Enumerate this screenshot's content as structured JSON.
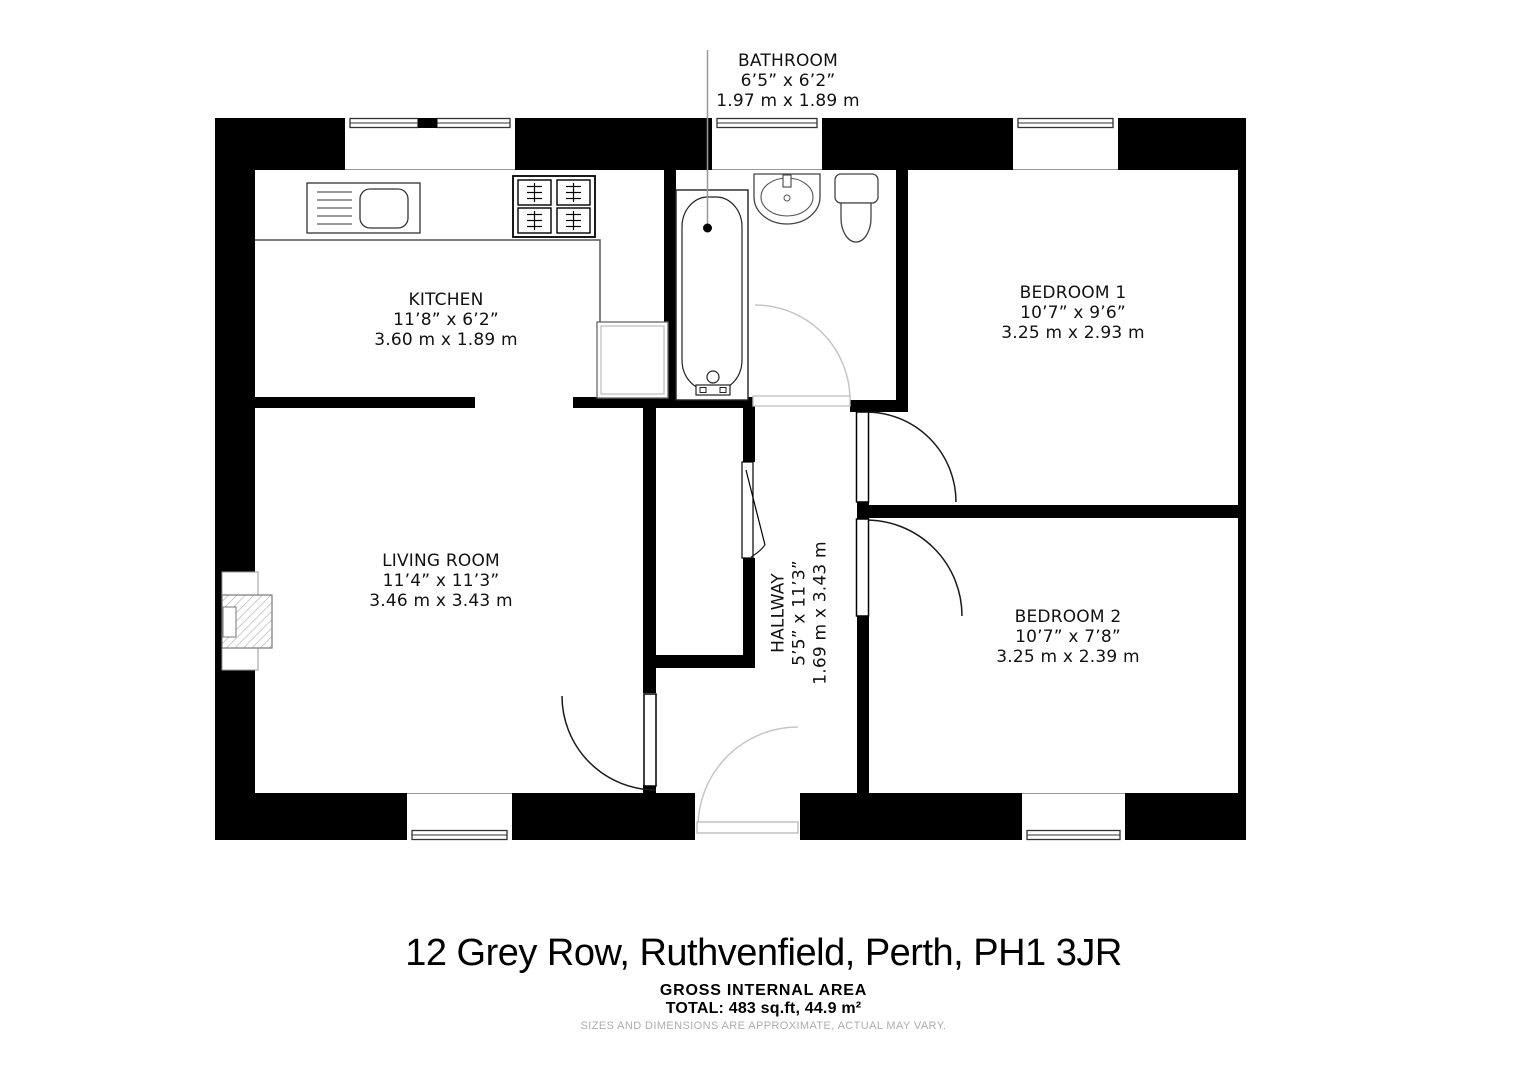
{
  "floor_plan": {
    "rooms": [
      {
        "name": "BATHROOM",
        "imperial": "6’5” x 6’2”",
        "metric": "1.97 m x 1.89 m"
      },
      {
        "name": "KITCHEN",
        "imperial": "11’8” x 6’2”",
        "metric": "3.60 m x 1.89 m"
      },
      {
        "name": "BEDROOM 1",
        "imperial": "10’7” x 9’6”",
        "metric": "3.25 m x 2.93 m"
      },
      {
        "name": "LIVING ROOM",
        "imperial": "11’4” x 11’3”",
        "metric": "3.46 m x 3.43 m"
      },
      {
        "name": "HALLWAY",
        "imperial": "5’5” x 11’3”",
        "metric": "1.69 m x 3.43 m"
      },
      {
        "name": "BEDROOM 2",
        "imperial": "10’7” x 7’8”",
        "metric": "3.25 m x 2.39 m"
      }
    ],
    "fixtures": [
      "kitchen-sink",
      "hob",
      "kitchen-appliance",
      "bathtub",
      "washbasin",
      "toilet",
      "fireplace"
    ],
    "colors": {
      "wall": "#000000",
      "background": "#ffffff",
      "door_swing_dark": "#1a1a1a",
      "door_swing_light": "#c6c6c6",
      "leader_line": "#999999",
      "fixture_line": "#444444",
      "disclaimer_text": "#adadad"
    }
  },
  "footer": {
    "address": "12 Grey Row, Ruthvenfield, Perth, PH1 3JR",
    "area_heading": "GROSS INTERNAL AREA",
    "area_total": "TOTAL: 483 sq.ft, 44.9 m²",
    "disclaimer": "SIZES AND DIMENSIONS ARE APPROXIMATE, ACTUAL MAY VARY."
  }
}
